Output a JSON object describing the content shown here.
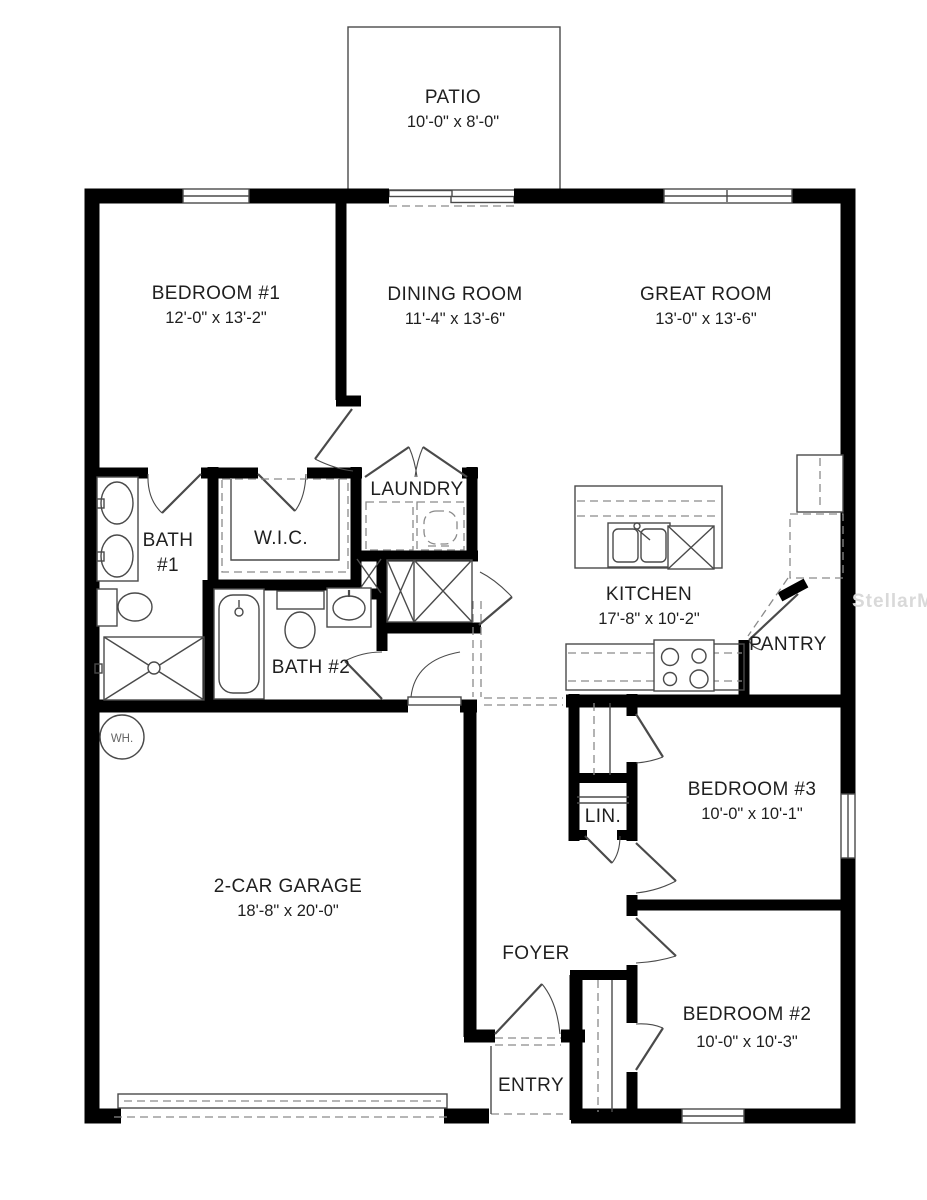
{
  "watermark": "StellarMLS",
  "rooms": {
    "patio": {
      "name": "PATIO",
      "dims": "10'-0\" x 8'-0\""
    },
    "bedroom1": {
      "name": "BEDROOM #1",
      "dims": "12'-0\" x 13'-2\""
    },
    "dining": {
      "name": "DINING ROOM",
      "dims": "11'-4\" x 13'-6\""
    },
    "great": {
      "name": "GREAT ROOM",
      "dims": "13'-0\" x 13'-6\""
    },
    "laundry": {
      "name": "LAUNDRY"
    },
    "bath1": {
      "name": "BATH",
      "number": "#1"
    },
    "wic": {
      "name": "W.I.C."
    },
    "kitchen": {
      "name": "KITCHEN",
      "dims": "17'-8\" x 10'-2\""
    },
    "pantry": {
      "name": "PANTRY"
    },
    "bath2": {
      "name": "BATH #2"
    },
    "water_heater": {
      "name": "WH."
    },
    "garage": {
      "name": "2-CAR GARAGE",
      "dims": "18'-8\" x 20'-0\""
    },
    "bedroom3": {
      "name": "BEDROOM #3",
      "dims": "10'-0\" x 10'-1\""
    },
    "linen": {
      "name": "LIN."
    },
    "foyer": {
      "name": "FOYER"
    },
    "bedroom2": {
      "name": "BEDROOM #2",
      "dims": "10'-0\" x 10'-3\""
    },
    "entry": {
      "name": "ENTRY"
    }
  },
  "colors": {
    "wall": "#000000",
    "line": "#4a4a4a",
    "dash": "#8a8a8a",
    "ink": "#1f1f1f",
    "wm": "#d9d9d9",
    "bg": "#ffffff"
  }
}
